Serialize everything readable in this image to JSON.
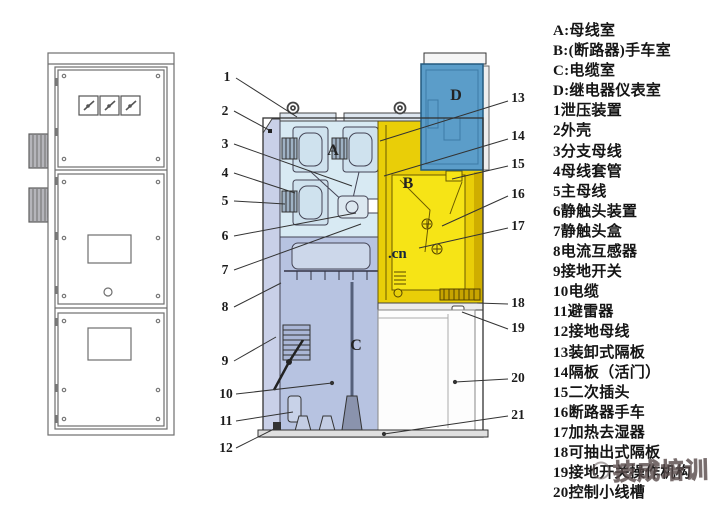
{
  "legend": {
    "items": [
      "A:母线室",
      "B:(断路器)手车室",
      "C:电缆室",
      "D:继电器仪表室",
      "1泄压装置",
      "2外壳",
      "3分支母线",
      "4母线套管",
      "5主母线",
      "6静触头装置",
      "7静触头盒",
      "8电流互感器",
      "9接地开关",
      "10电缆",
      "11避雷器",
      "12接地母线",
      "13装卸式隔板",
      "14隔板（活门）",
      "15二次插头",
      "16断路器手车",
      "17加热去湿器",
      "18可抽出式隔板",
      "19接地开关操作机构",
      "20控制小线槽"
    ]
  },
  "zones": {
    "a": "A",
    "b": "B",
    "c": "C",
    "d": "D"
  },
  "callouts": [
    "1",
    "2",
    "3",
    "4",
    "5",
    "6",
    "7",
    "8",
    "9",
    "10",
    "11",
    "12",
    "13",
    "14",
    "15",
    "16",
    "17",
    "18",
    "19",
    "20",
    "21"
  ],
  "watermarks": {
    "cn_text": ".cn",
    "brand_text": "技成培训"
  },
  "colors": {
    "zone_a_fill": "#d8eaf3",
    "zone_b_fill": "#e9ce08",
    "zone_b_cart": "#f6e416",
    "zone_c_fill": "#b7c3e1",
    "zone_d_fill": "#5b9dc9",
    "left_wall": "#c9d0e8",
    "outline": "#333333"
  }
}
